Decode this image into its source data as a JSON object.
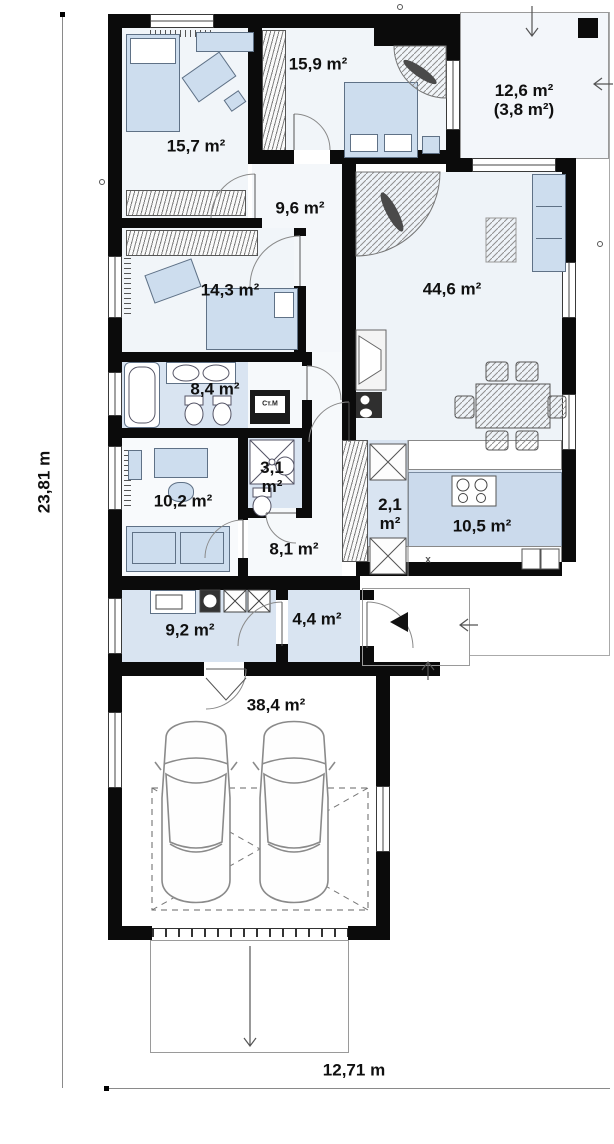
{
  "dimensions": {
    "left": "23,81 m",
    "bottom": "12,71 m"
  },
  "rooms": {
    "bedroom1": {
      "area": "15,7 m²"
    },
    "bedroom2": {
      "area": "15,9 m²"
    },
    "terrace": {
      "area": "12,6 m²",
      "area_secondary": "(3,8 m²)"
    },
    "corridor": {
      "area": "9,6 m²"
    },
    "bedroom3": {
      "area": "14,3 m²"
    },
    "living": {
      "area": "44,6 m²"
    },
    "bathroom": {
      "area": "8,4 m²"
    },
    "shower": {
      "area_value": "3,1",
      "area_unit": "m²"
    },
    "study": {
      "area": "10,2 m²"
    },
    "hall": {
      "area": "8,1 m²"
    },
    "pantry": {
      "area_value": "2,1",
      "area_unit": "m²"
    },
    "kitchen": {
      "area": "10,5 m²"
    },
    "utility": {
      "area": "9,2 m²"
    },
    "vestibule": {
      "area": "4,4 m²"
    },
    "garage": {
      "area": "38,4 m²"
    }
  },
  "labels": {
    "washing_machine": "Ст.М",
    "kitchen_counter": "x"
  },
  "colors": {
    "wall": "#0b0b0b",
    "room_blue": "#d9e4f1",
    "room_light": "#f1f5f9",
    "furniture": "#cdddee"
  }
}
